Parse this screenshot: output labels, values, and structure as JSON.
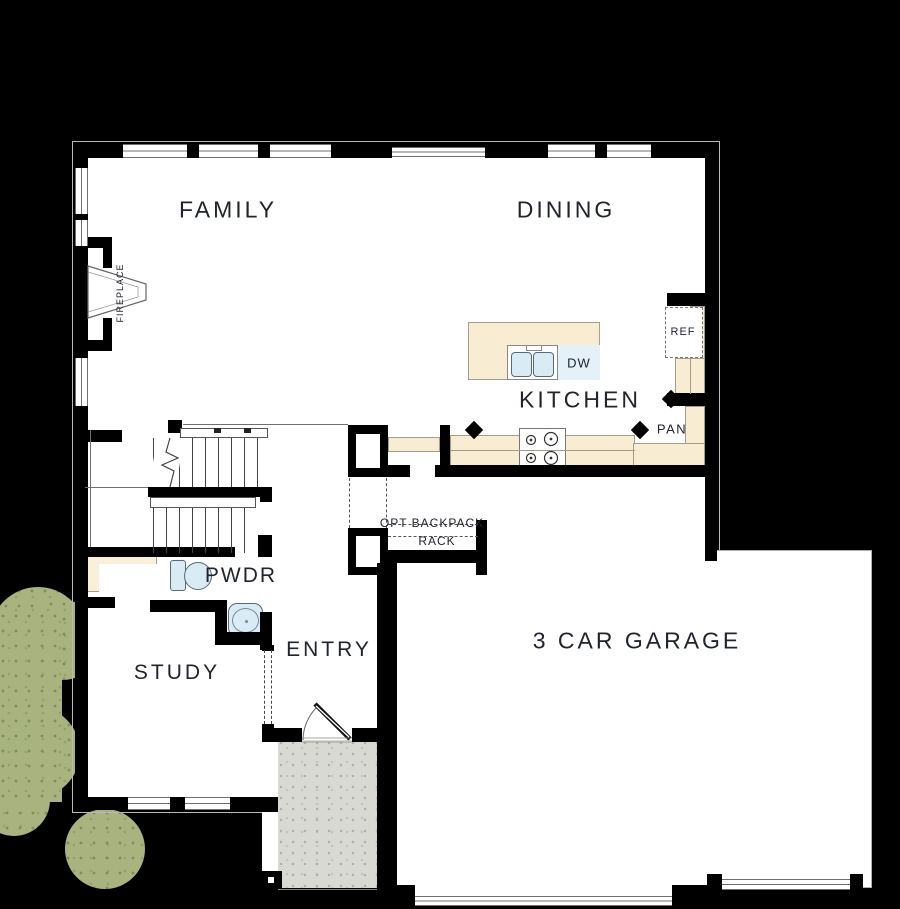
{
  "rooms": {
    "family": "FAMILY",
    "dining": "DINING",
    "kitchen": "KITCHEN",
    "study": "STUDY",
    "entry": "ENTRY",
    "powder": "PWDR",
    "garage": "3 CAR GARAGE"
  },
  "fixtures": {
    "fridge": "REF",
    "dishwasher": "DW",
    "pantry": "PAN",
    "fireplace": "FIREPLACE"
  },
  "annotations": {
    "backpack_line1": "OPT BACKPACK",
    "backpack_line2": "RACK"
  },
  "colors": {
    "background": "#000000",
    "wall": "#000000",
    "floor": "#ffffff",
    "counter": "#f8ecd3",
    "fixture_blue": "#d9ebf5",
    "porch": "#d9d9d4",
    "shrub": "#a8b37f",
    "text": "#20242e"
  }
}
